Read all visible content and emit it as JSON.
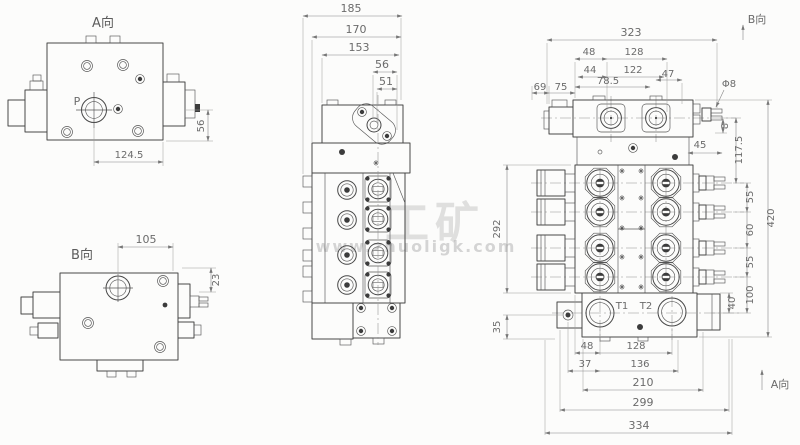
{
  "watermark": {
    "brand_cn": "工矿",
    "brand_url": "www.zhuoligk.com"
  },
  "view_a": {
    "label": "A向",
    "port": "P",
    "dim_width": "124.5",
    "dim_height": "56"
  },
  "view_b": {
    "label": "B向",
    "dim_width": "105",
    "dim_offset": "23"
  },
  "view_side": {
    "dims": {
      "overall": "185",
      "d170": "170",
      "d153": "153",
      "d56": "56",
      "d51": "51"
    }
  },
  "view_front": {
    "dir_label_top": "B向",
    "dir_label_bottom": "A向",
    "ports": {
      "t1": "T1",
      "t2": "T2"
    },
    "top": {
      "overall": "323",
      "d48": "48",
      "d128": "128",
      "d44": "44",
      "d122": "122",
      "d69": "69",
      "d75": "75",
      "d78_5": "78.5",
      "d47": "47",
      "dia": "Φ8"
    },
    "right": {
      "d8": "8",
      "d117_5": "117.5",
      "d55a": "55",
      "d60": "60",
      "d55b": "55",
      "d45": "45",
      "d420": "420",
      "d100": "100",
      "d40": "40"
    },
    "left": {
      "d292": "292",
      "d35": "35"
    },
    "bottom": {
      "d48": "48",
      "d128": "128",
      "d37": "37",
      "d136": "136",
      "d210": "210",
      "d299": "299",
      "d334": "334"
    }
  }
}
